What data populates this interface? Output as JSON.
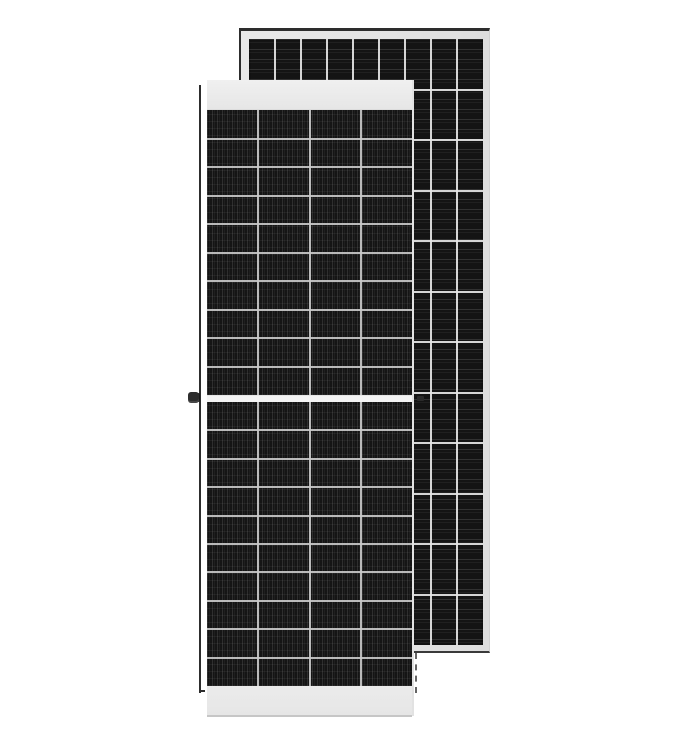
{
  "scene": {
    "label": "Product image of two monocrystalline solar panel modules on a white background, front module overlapping a larger rear module",
    "text_content": "none"
  },
  "colors": {
    "background": "#ffffff",
    "frame": "#e3e3e3",
    "edge": "#2d2d2d",
    "front-cell": "#151515",
    "front-grid": "#c9c9c9",
    "back-cell": "#141414",
    "back-grid": "#e6e6e6",
    "band": "#e6e6e6",
    "band-edge": "#c6c6c6",
    "divider": "#f4f4f4"
  },
  "front_panel": {
    "label": "front solar panel module, portrait, white top and bottom bands, half-cut cell layout",
    "columns": 4,
    "rows_upper": 10,
    "rows_lower": 10,
    "cell_texture": "vertical busbar stripes",
    "features": {
      "top_band": true,
      "bottom_band": true,
      "center_divider": true,
      "grounding_screw": true,
      "left_edge_line": true
    }
  },
  "back_panel": {
    "label": "rear solar panel module, taller, light aluminum frame with dark top and left edge lines",
    "columns": 9,
    "rows": 12,
    "cell_texture": "horizontal stripes"
  }
}
